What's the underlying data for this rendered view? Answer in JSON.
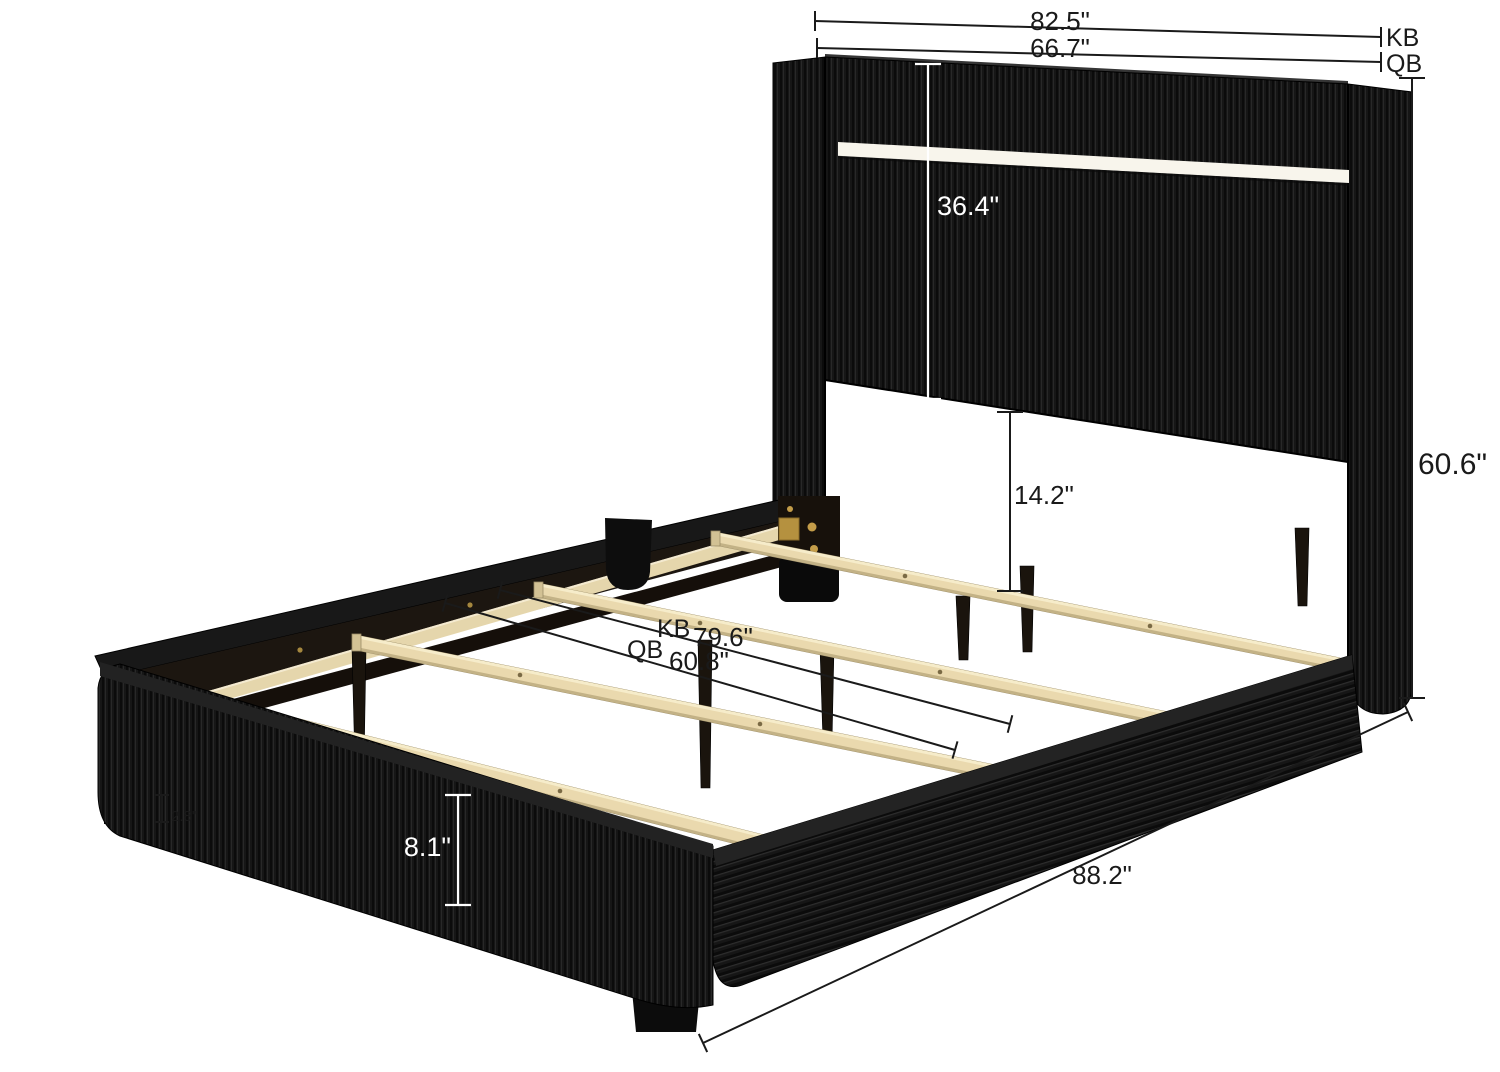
{
  "title": "Upholstered bed frame dimension diagram",
  "product": {
    "type": "Corduroy upholstered platform bed with LED headboard and wood slats"
  },
  "labels": {
    "width_kb": "82.5\"",
    "tag_kb": "KB",
    "width_qb": "66.7\"",
    "tag_qb": "QB",
    "headboard_panel_height": "36.4\"",
    "headboard_total_height": "60.6\"",
    "panel_to_slat": "14.2\"",
    "slat_kb_tag": "KB",
    "slat_kb_length": "79.6\"",
    "slat_qb_tag": "QB",
    "slat_qb_length": "60.8\"",
    "rail_height": "8.1\"",
    "leg_height": "2.8\"",
    "bed_length": "88.2\""
  },
  "colors": {
    "fabric_black": "#141414",
    "fabric_rib_dark": "#0b0b0b",
    "fabric_rib_light": "#2d2d2d",
    "rail_inner_dark": "#1c1610",
    "wood_slat": "#ead9ae",
    "wood_slat_shadow": "#c3b286",
    "led_strip": "#f8f5ec",
    "hardware_gold": "#bd9747",
    "dimension_line": "#1a1a1a",
    "dimension_line_light": "#ffffff",
    "background": "#ffffff"
  }
}
